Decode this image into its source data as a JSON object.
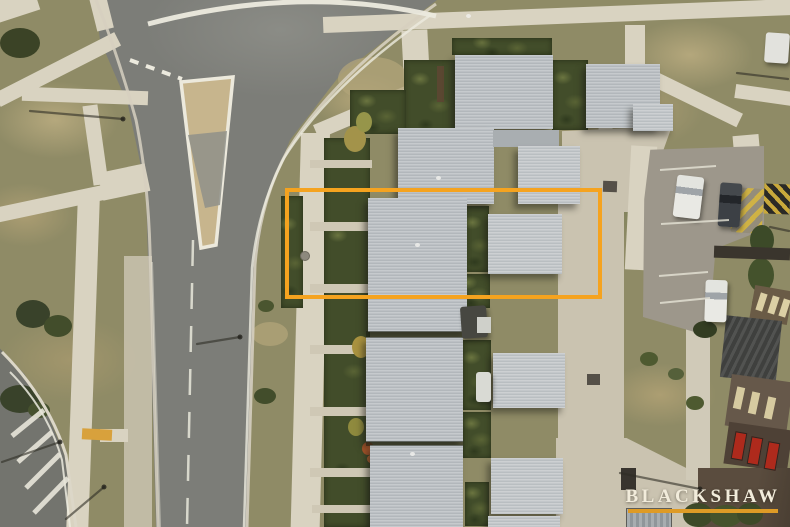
{
  "watermark": {
    "text": "BLACKSHAW",
    "text_color": "#F2ECDB",
    "underline_color": "#DE9B26"
  },
  "property_overlay": {
    "border_color": "#F5A31F"
  },
  "palette": {
    "grass": "#8F8B66",
    "asphalt": "#7C7D78",
    "footpath": "#D9D3C1",
    "concrete": "#CAC3B0",
    "roof_metal": "#BDC2C6",
    "garden": "#424D2A",
    "island_paint": "#C7B58D"
  }
}
